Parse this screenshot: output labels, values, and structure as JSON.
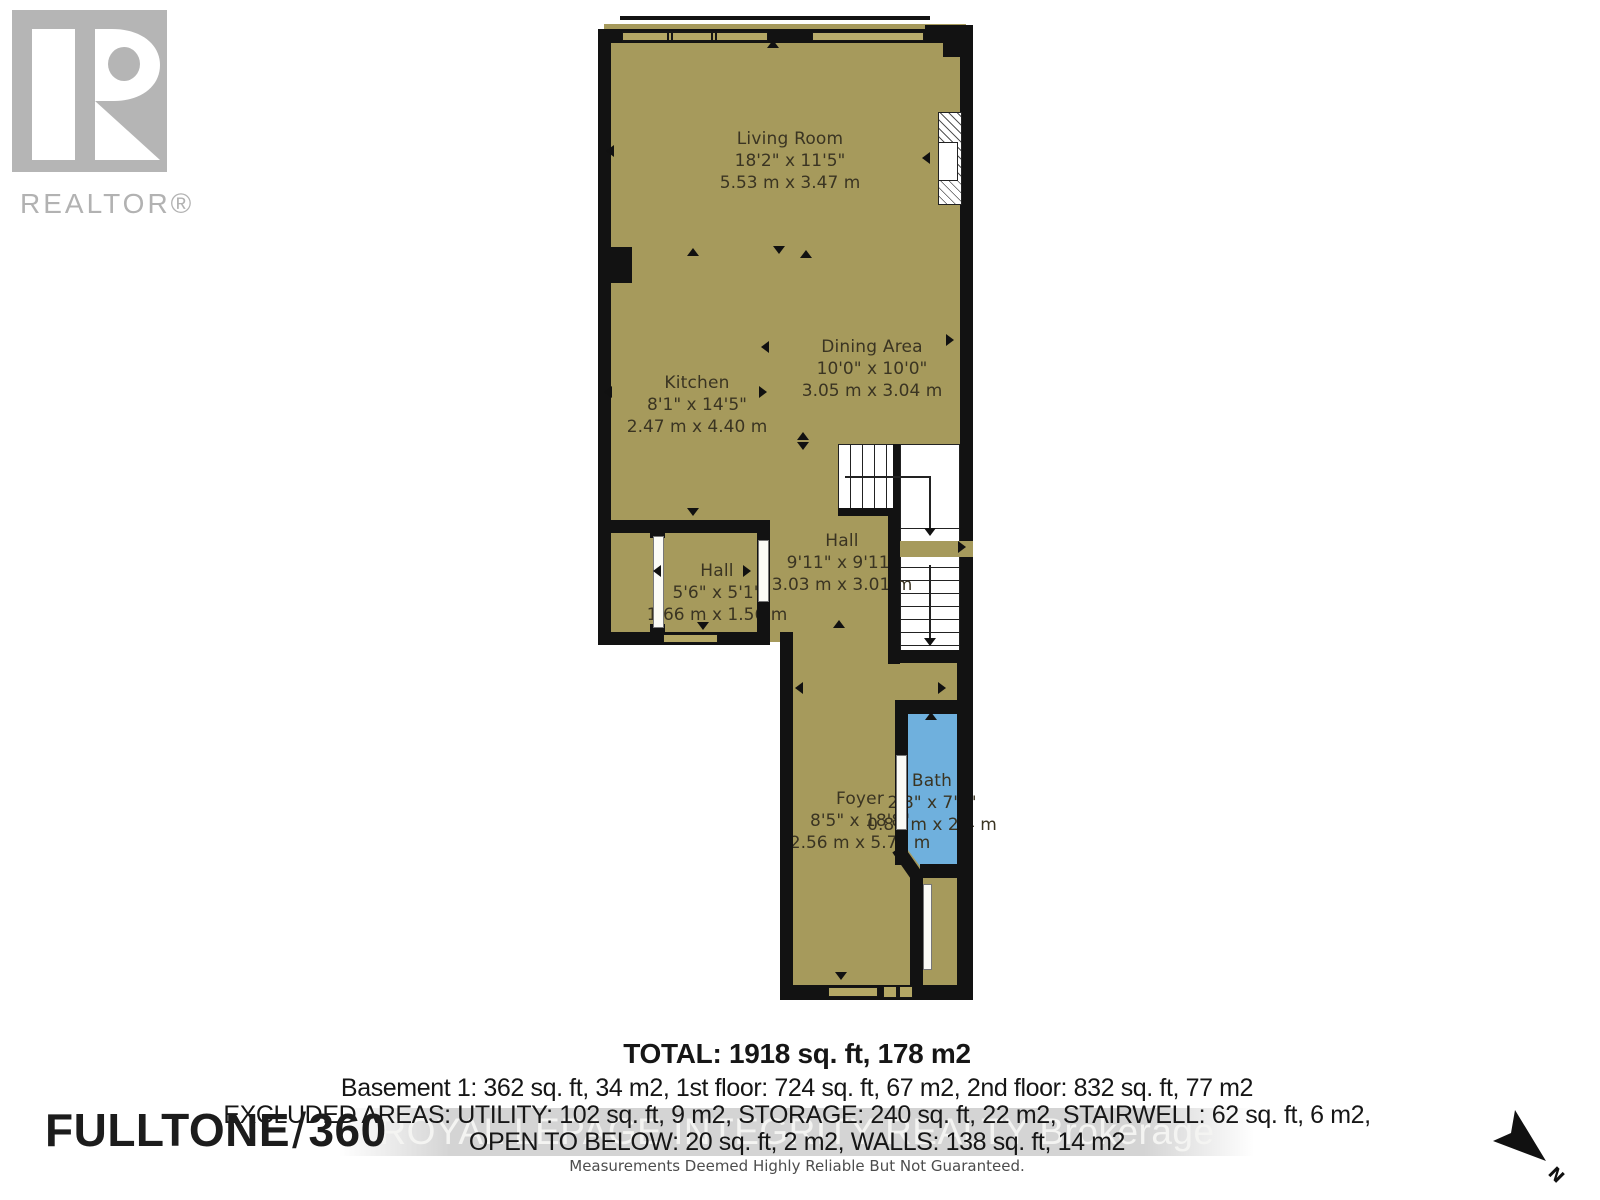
{
  "branding": {
    "realtor_logo_text": "REALTOR®",
    "fulltone": "FULLTONE",
    "fulltone_slash": "/",
    "fulltone_360": "360"
  },
  "rooms": {
    "living_room": {
      "name": "Living Room",
      "imperial": "18'2\" x 11'5\"",
      "metric": "5.53 m x 3.47 m"
    },
    "dining_area": {
      "name": "Dining Area",
      "imperial": "10'0\" x 10'0\"",
      "metric": "3.05 m x 3.04 m"
    },
    "kitchen": {
      "name": "Kitchen",
      "imperial": "8'1\" x 14'5\"",
      "metric": "2.47 m x 4.40 m"
    },
    "hall_small": {
      "name": "Hall",
      "imperial": "5'6\" x 5'1\"",
      "metric": "1.66 m x 1.56 m"
    },
    "hall": {
      "name": "Hall",
      "imperial": "9'11\" x 9'11\"",
      "metric": "3.03 m x 3.01 m"
    },
    "foyer": {
      "name": "Foyer",
      "imperial": "8'5\" x 18'8\"",
      "metric": "2.56 m x 5.70 m"
    },
    "bath": {
      "name": "Bath",
      "imperial": "2'8\" x 7'1\"",
      "metric": "0.81 m x 2.4 m"
    }
  },
  "summary": {
    "total": "TOTAL: 1918 sq. ft, 178 m2",
    "floors": "Basement 1: 362 sq. ft, 34 m2, 1st floor: 724 sq. ft, 67 m2, 2nd floor: 832 sq. ft, 77 m2",
    "excluded": "EXCLUDED AREAS: UTILITY: 102 sq. ft, 9 m2, STORAGE: 240 sq. ft, 22 m2, STAIRWELL: 62 sq. ft, 6 m2,",
    "open_below": "OPEN TO BELOW: 20 sq. ft, 2 m2, WALLS: 138 sq. ft, 14 m2",
    "disclaimer": "Measurements Deemed Highly Reliable But Not Guaranteed."
  },
  "watermark": "ROYAL LEPAGE INTEGRITY REALTY Brokerage",
  "compass": {
    "label": "N"
  },
  "colors": {
    "floor": "#a69a5c",
    "wall": "#121212",
    "bath_fill": "#6fb0dd",
    "window_fill": "#b4a765",
    "logo_grey": "#b5b5b5",
    "watermark_band": "#d2d2d2"
  }
}
